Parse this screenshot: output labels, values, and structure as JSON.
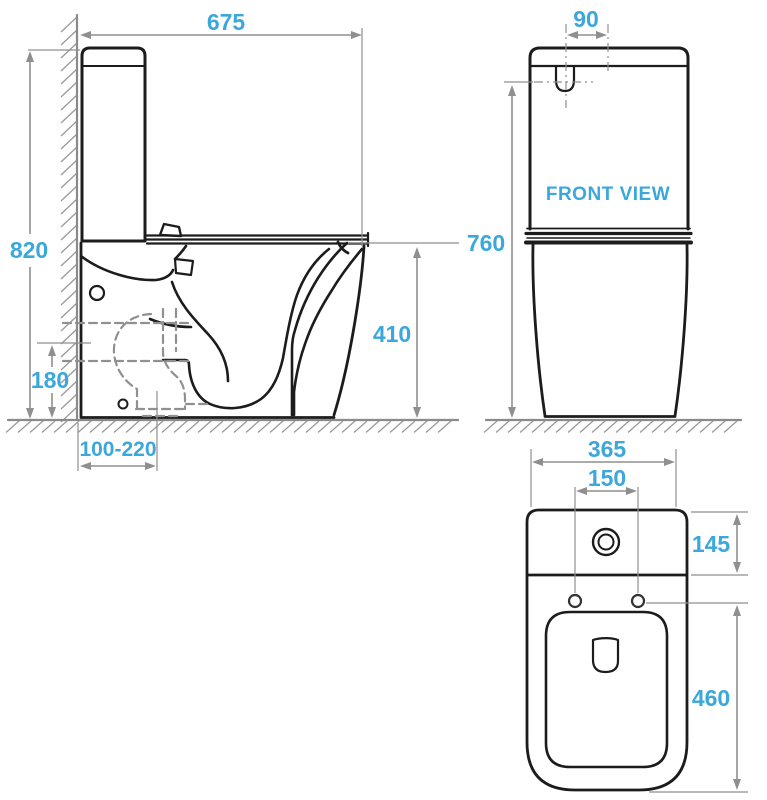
{
  "drawing": {
    "title": "Back-to-wall toilet suite technical dimension drawing",
    "units": "mm",
    "colors": {
      "dimension_text": "#3BA7DA",
      "outline": "#1C1C1C",
      "dimension_line": "#8F8F8F",
      "hatch": "#9A9A9A"
    },
    "views": {
      "side": {
        "dims": {
          "overall_depth": "675",
          "overall_height": "820",
          "seat_height": "410",
          "inlet_height": "180",
          "outlet_setout_range": "100-220"
        }
      },
      "front": {
        "label": "FRONT VIEW",
        "dims": {
          "button_width": "90",
          "tank_height": "760"
        }
      },
      "top": {
        "dims": {
          "overall_width": "365",
          "hinge_hole_centres": "150",
          "tank_depth": "145",
          "bowl_depth": "460"
        }
      }
    }
  }
}
